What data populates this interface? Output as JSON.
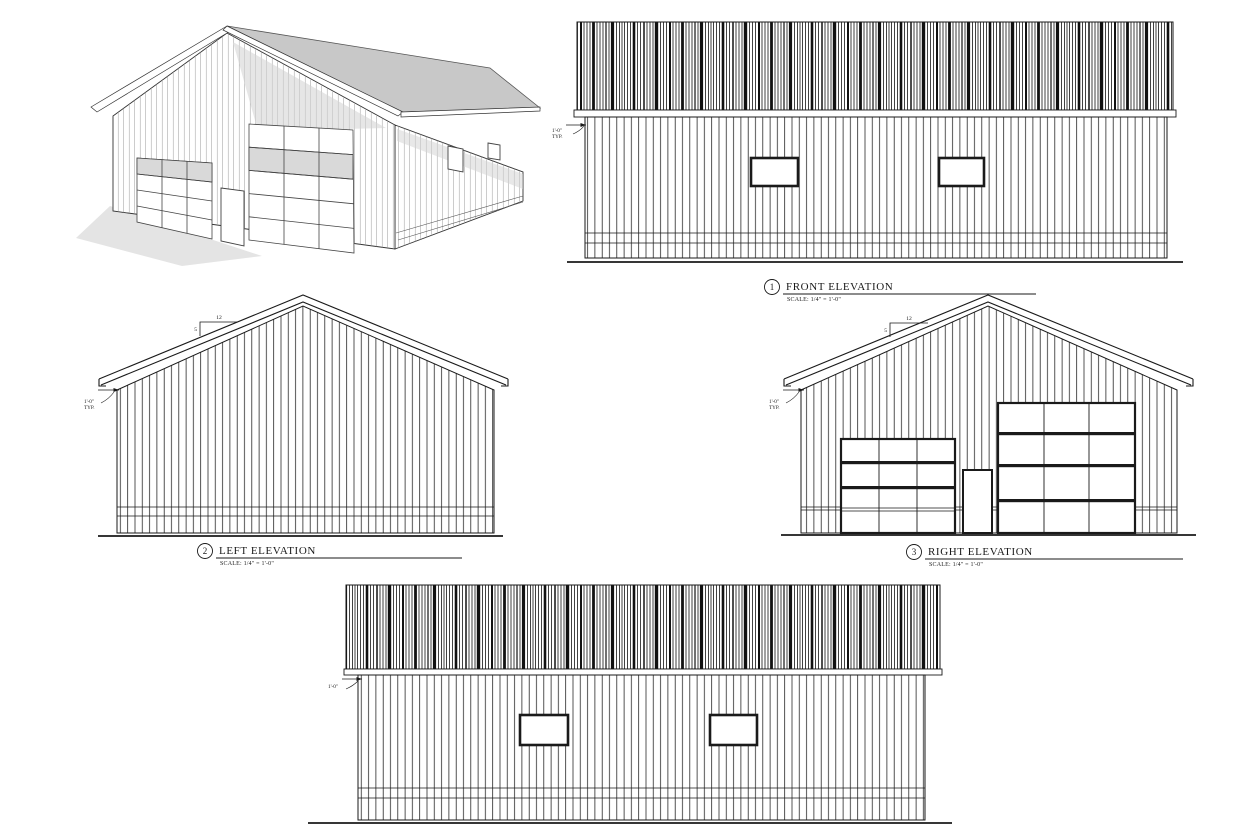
{
  "views": {
    "front": {
      "number": "1",
      "title": "FRONT ELEVATION",
      "scale": "SCALE:  1/4\" = 1'-0\""
    },
    "left": {
      "number": "2",
      "title": "LEFT ELEVATION",
      "scale": "SCALE:  1/4\" = 1'-0\""
    },
    "right": {
      "number": "3",
      "title": "RIGHT ELEVATION",
      "scale": "SCALE:  1/4\" = 1'-0\""
    }
  },
  "annotations": {
    "eave_overhang": "1'-0\"",
    "typical": "TYP.",
    "roof_pitch": {
      "rise": "5",
      "run": "12"
    }
  },
  "colors": {
    "line": "#1a1a1a",
    "roof_gray": "#c8c8c8",
    "shade_gray": "#d2d2d2",
    "shadow_gray": "#e4e4e4"
  }
}
